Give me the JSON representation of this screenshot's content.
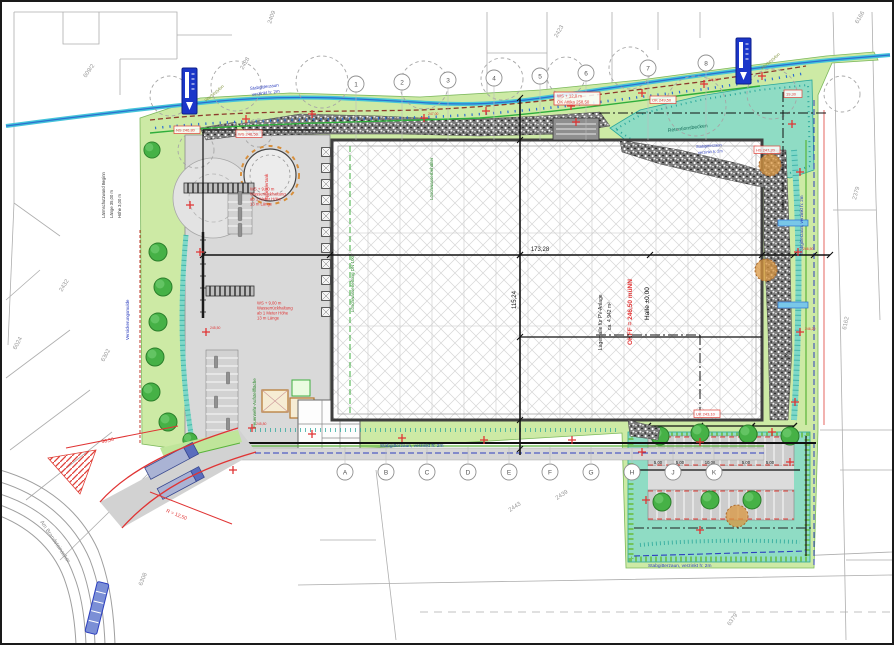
{
  "labels": {
    "fence_line1": "Stabgitterzaun",
    "fence_line2": "verzinkt h: 2m",
    "fence_full": "Stabgitterzaun, verzinkt h: 2m",
    "pylon": "Werbepylon",
    "road_name": "Am Brandsteinacker",
    "basin": "Retentionsbecken",
    "swale": "Versickerungsmulde",
    "tank": "Sprinklertank"
  },
  "hall": {
    "name": "Lagerhalle für PV-Anlage",
    "area": "ca. 4.942 m²",
    "okff": "OKFF = 246,50 müNN",
    "level": "Halle ±0,00"
  },
  "green_notes": {
    "fire_area": "Feuerwehr-Aufstellfläche",
    "fire_line": "Löschwasserleitung DN 100",
    "sprinkler": "Löschwasserbehälter"
  },
  "wall_note": [
    "Lärmschutzwand Beginn",
    "Länge 35,00 m",
    "Höhe 3,00 m"
  ],
  "red_notes": {
    "block_a": [
      "WS + 9,00 m",
      "Wasserrückhaltung",
      "ab 1 Meter Höhe",
      "13 m Länge"
    ],
    "block_c": [
      "WS + 12,0 m",
      "OK Attika 258,50"
    ],
    "levels": [
      "246,50",
      "246,20",
      "245,80",
      "247,00",
      "246,80",
      "245,50"
    ],
    "boxes": [
      "NS 246,80",
      "WS 246,50",
      "OK 249,50",
      "HS 247,20",
      "UK 243,10",
      "19,30"
    ],
    "road_dim": "36,50",
    "road_radius": "R = 12,50"
  },
  "dims": {
    "main_width": "173,28",
    "main_height": "115,24",
    "strip": "6,00",
    "parking": [
      "5,00",
      "5,00",
      "10,00",
      "5,00",
      "5,00"
    ]
  },
  "axes": {
    "top": [
      "1",
      "2",
      "3",
      "4",
      "5",
      "6",
      "7",
      "8"
    ],
    "bottom": [
      "A",
      "B",
      "C",
      "D",
      "E",
      "F",
      "G",
      "H",
      "J",
      "K"
    ]
  },
  "parcels": [
    "2409",
    "2428",
    "609/2",
    "2423",
    "6166",
    "2379",
    "6162",
    "6302",
    "6024",
    "2432",
    "2443",
    "2439",
    "6308",
    "6379"
  ]
}
